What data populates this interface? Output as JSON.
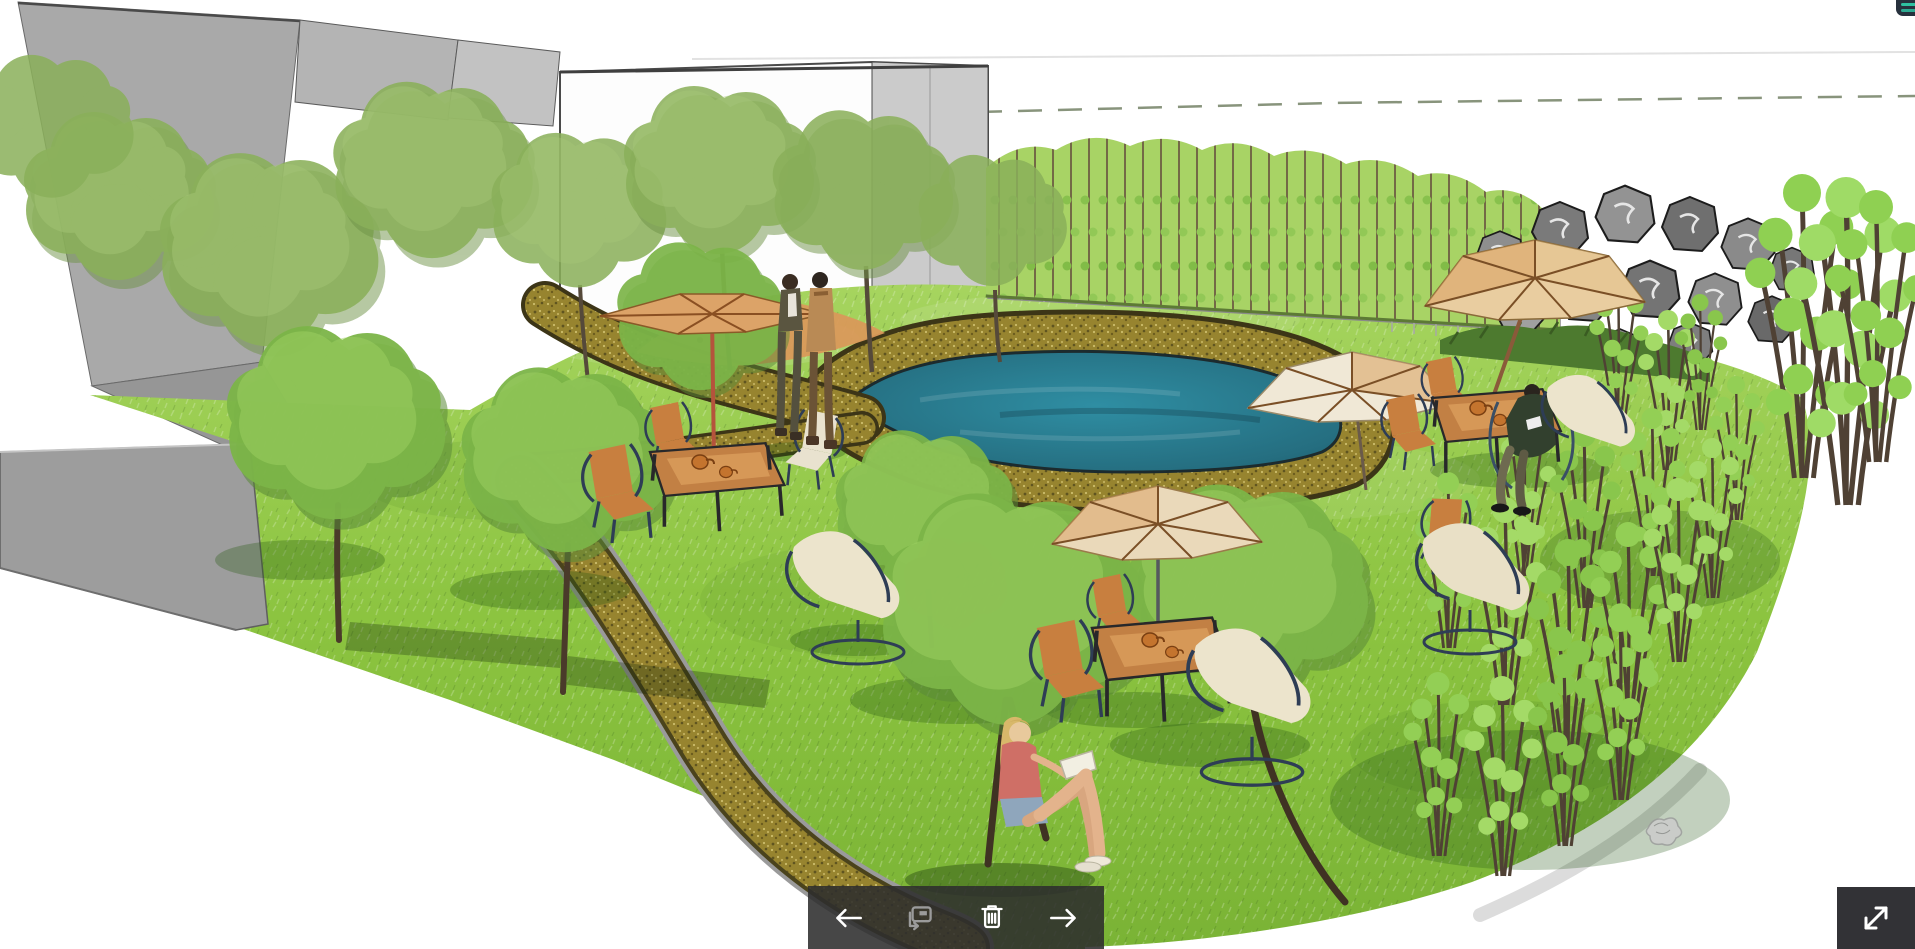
{
  "canvas": {
    "width": 1915,
    "height": 949,
    "background": "#ffffff"
  },
  "viewer": {
    "toolbar": {
      "background": "rgba(45,45,45,0.88)",
      "icon_color": "#ffffff",
      "disabled_icon_color": "#9b9b9b",
      "buttons": [
        {
          "icon": "arrow-left-icon",
          "enabled": true
        },
        {
          "icon": "comment-annotation-icon",
          "enabled": false
        },
        {
          "icon": "trash-icon",
          "enabled": true
        },
        {
          "icon": "arrow-right-icon",
          "enabled": true
        }
      ]
    },
    "fullscreen_button": {
      "icon": "expand-diagonal-icon",
      "background": "#323236",
      "icon_color": "#ffffff"
    },
    "corner_menu_button": {
      "icon": "menu-partial-icon",
      "background": "#27313d",
      "accent_color": "#2fc0a0"
    }
  },
  "scene": {
    "kind": "landscape-architecture-perspective-rendering",
    "palette": {
      "pond_teal": "#2b8296",
      "lawn_green": "#8cc63f",
      "gravel_gold": "#97842f",
      "road_gray": "#9d9d9d",
      "building_gray": "#a9a9a9",
      "rock_gray": "#8a8a8a",
      "umbrella_tan": "#d9a05f",
      "hedge_light_green": "#a8d365",
      "hedge_dark_green": "#4d7a2f",
      "chair_orange": "#c87f3f",
      "lounge_cream": "#ece4cc"
    },
    "features": [
      "gray building massing",
      "white outlined building",
      "kidney-shaped pond with gravel edge",
      "winding gravel path",
      "asphalt road",
      "deciduous trees",
      "light bamboo hedge row with fence",
      "stacked boulder wall",
      "bamboo grove",
      "patio table sets with market umbrellas",
      "couple walking on path",
      "woman reading on lawn",
      "person reading in patio chair"
    ]
  }
}
